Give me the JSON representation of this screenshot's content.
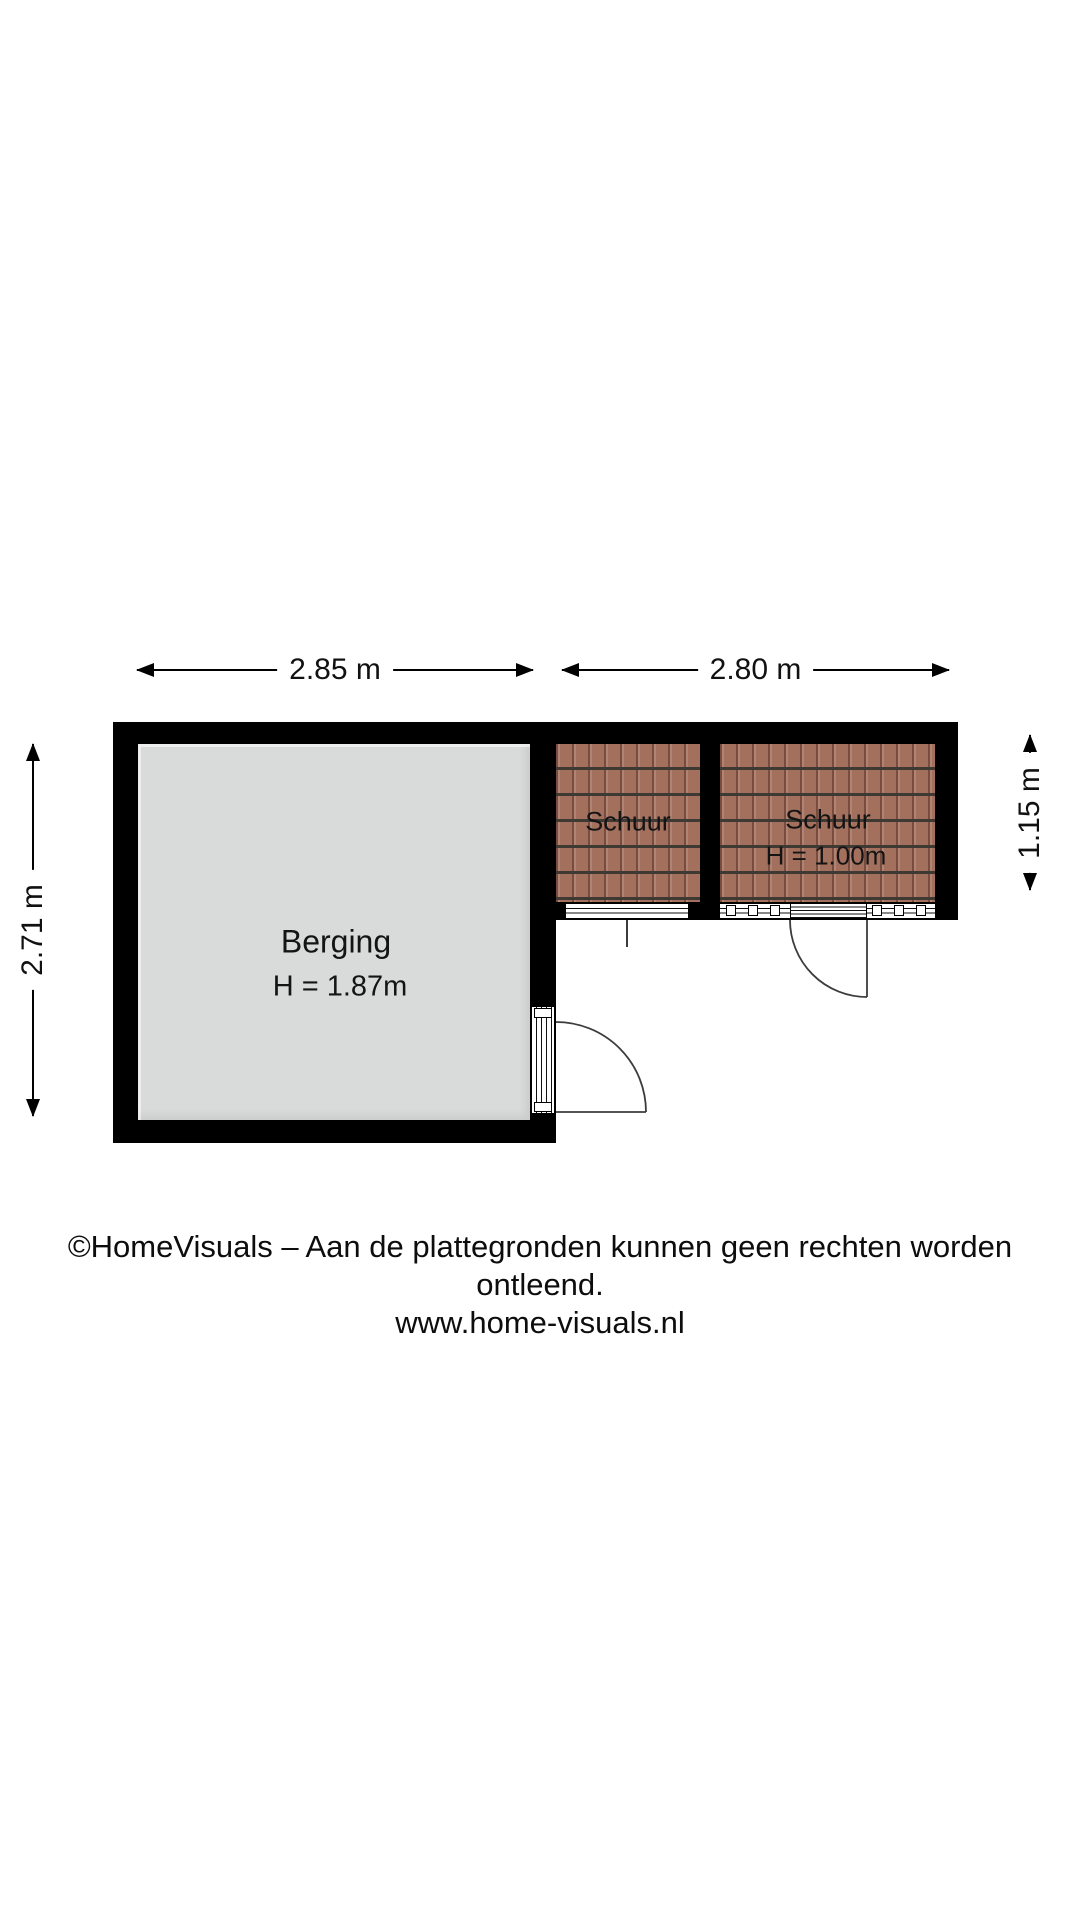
{
  "colors": {
    "wall": "#000000",
    "floor": "#d9dbda",
    "tile_base": "#a3705e",
    "tile_line": "#3e3933",
    "text": "#1a1a1a"
  },
  "dimensions": {
    "top_left": "2.85 m",
    "top_right": "2.80 m",
    "left": "2.71 m",
    "right": "1.15 m"
  },
  "rooms": {
    "berging": {
      "name": "Berging",
      "height_label": "H = 1.87m"
    },
    "schuur_left": {
      "name": "Schuur"
    },
    "schuur_right": {
      "name": "Schuur",
      "height_label": "H = 1.00m"
    }
  },
  "footer": {
    "line1": "©HomeVisuals – Aan de plattegronden kunnen geen rechten worden ontleend.",
    "line2": "www.home-visuals.nl"
  }
}
